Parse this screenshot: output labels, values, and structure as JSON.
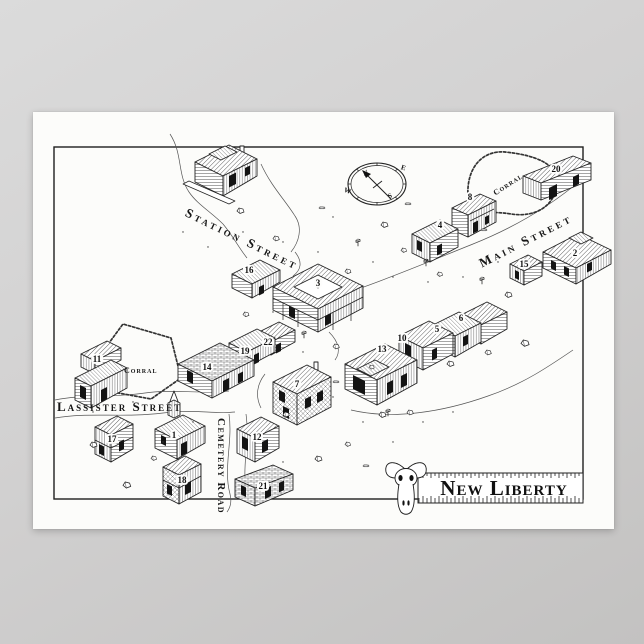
{
  "poster": {
    "title": "New Liberty",
    "ink_color": "#1c1c1c",
    "paper_color": "#fcfcfa",
    "streets": {
      "station": "Station Street",
      "main": "Main Street",
      "lassister": "Lassister Street",
      "cemetery": "Cemetery Road"
    },
    "corrals": {
      "left": "Corral",
      "right": "Corral"
    },
    "compass": {
      "north": "N",
      "east": "E",
      "south": "S",
      "west": "W"
    },
    "buildings": [
      {
        "number": "1"
      },
      {
        "number": "2"
      },
      {
        "number": "3"
      },
      {
        "number": "4"
      },
      {
        "number": "5"
      },
      {
        "number": "6"
      },
      {
        "number": "7"
      },
      {
        "number": "8"
      },
      {
        "number": "10"
      },
      {
        "number": "11"
      },
      {
        "number": "12"
      },
      {
        "number": "13"
      },
      {
        "number": "14"
      },
      {
        "number": "15"
      },
      {
        "number": "16"
      },
      {
        "number": "17"
      },
      {
        "number": "18"
      },
      {
        "number": "19"
      },
      {
        "number": "20"
      },
      {
        "number": "21"
      },
      {
        "number": "22"
      }
    ]
  }
}
